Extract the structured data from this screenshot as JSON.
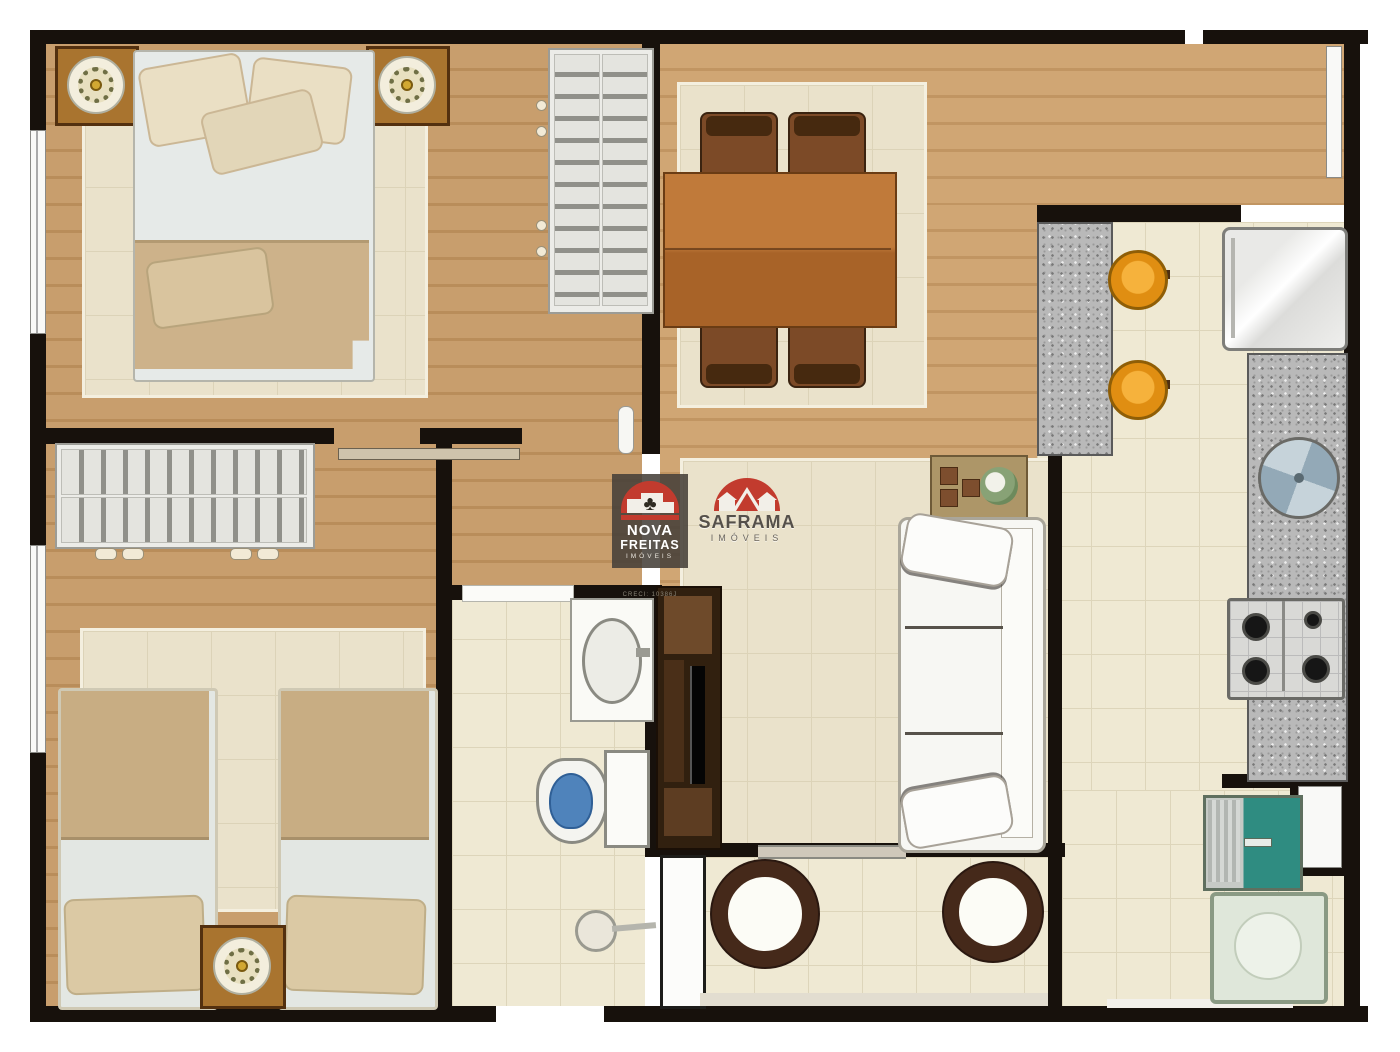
{
  "watermarks": {
    "nova_freitas": {
      "name_line1": "NOVA",
      "name_line2": "FREITAS",
      "subtitle": "IMÓVEIS",
      "creci": "CRECI: 10386J",
      "tree_glyph": "♣"
    },
    "saframa": {
      "name": "SAFRAMA",
      "subtitle": "IMÓVEIS"
    }
  },
  "palette": {
    "wall": "#17110C",
    "wood": "#C89E6D",
    "wood_dark": "#B98D5A",
    "tile": "#EFE9D3",
    "rug": "#EAE2CB",
    "granite": "#B9B9B9",
    "accent_red": "#C23B2E",
    "stool_orange": "#E8940F",
    "laundry_teal": "#2F8C81",
    "toilet_water": "#4F83BB",
    "table_wood": "#B5743A",
    "chair_brown": "#46290F",
    "sofa_white": "#F7F7F3",
    "blanket_beige": "#C8AD83"
  },
  "plan": {
    "type": "apartment-floor-plan",
    "rooms": [
      {
        "name": "bedroom-double",
        "furniture": [
          "double-bed",
          "nightstand-with-lamp-left",
          "nightstand-with-lamp-right",
          "wardrobe-hanger-rack",
          "rug"
        ]
      },
      {
        "name": "bedroom-twin",
        "furniture": [
          "single-bed-left",
          "single-bed-right",
          "nightstand-with-lamp",
          "wardrobe-hanger-rack",
          "rug"
        ]
      },
      {
        "name": "dining-room",
        "furniture": [
          "dining-table",
          "four-chairs",
          "rug"
        ]
      },
      {
        "name": "living-room",
        "furniture": [
          "three-seat-sofa",
          "tv-panel",
          "side-table",
          "rug"
        ]
      },
      {
        "name": "kitchen",
        "furniture": [
          "breakfast-bar",
          "two-stools",
          "refrigerator",
          "round-sink",
          "four-burner-stove",
          "granite-counter"
        ]
      },
      {
        "name": "bathroom",
        "furniture": [
          "vanity-sink",
          "toilet",
          "shower"
        ]
      },
      {
        "name": "balcony",
        "furniture": [
          "round-table-left",
          "round-table-right"
        ]
      },
      {
        "name": "laundry",
        "furniture": [
          "laundry-tub",
          "washing-machine",
          "window"
        ]
      }
    ]
  }
}
